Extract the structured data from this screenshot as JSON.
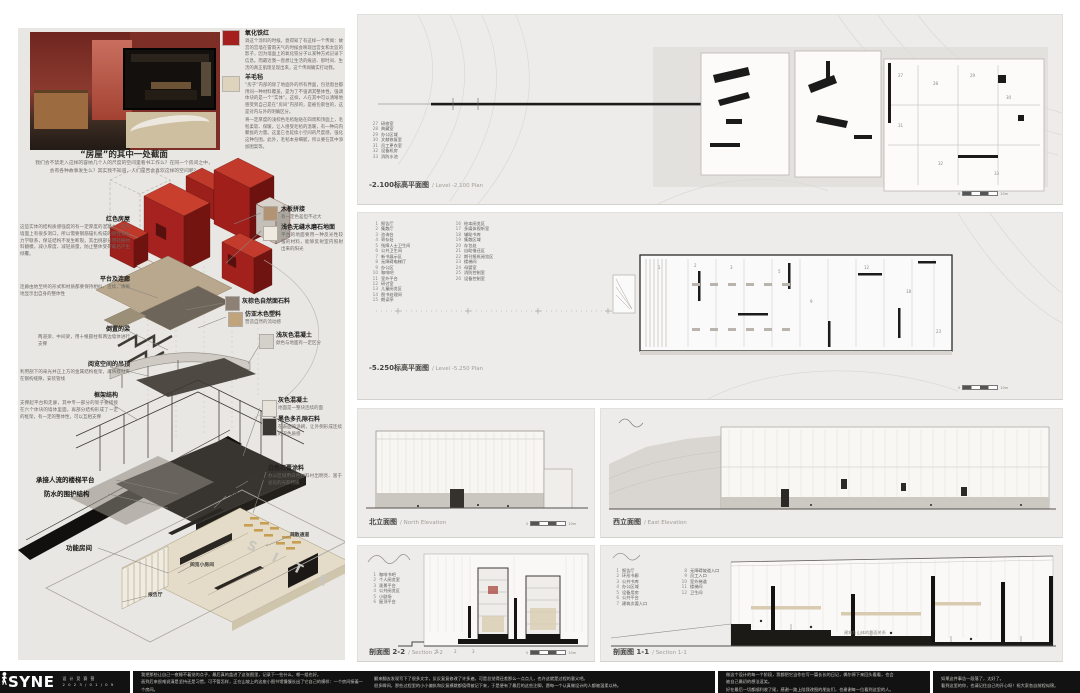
{
  "colors": {
    "accent_red": "#a5201c",
    "panel_bg": "#edecea",
    "footer_bg": "#121212"
  },
  "left": {
    "section_title": "“房屋”的其中一处截面",
    "section_body": "我们会不禁走入这样的容纳几个人的尺度的空间里看书工作么？在同一个房间之中，\n会有各种故事发生么？其实我不知道，人们是否会喜欢这样的空间呢？",
    "notes": [
      {
        "title": "氧化铁红",
        "swatch": "#a5201c",
        "body": "调这个涂料的时候，竟得知了有这样一个传闻：故宫的宫墙在雷雨天气的时候会映现出宫女和太监的影子，因为墙面上的氧化铁分子以某种方式记录下信息。而最近我一直想让生活的痕迹、那时间、生活的真正肌理呈现出来，这个传闻确实打动我。"
      },
      {
        "title": "羊毛毡",
        "swatch": "#ded3bd",
        "body": "“房子”内部的除了地面外的所有界面，包括窗台都用同一种材料覆盖，是为了不强调其整体性，强调体块的是一个“实体”。这样，人在其中可以清晰地感受到自己是在“房间”内部的，是被包裹住的，这是对内与外的明确区分。",
        "body2": "将一定厚度的浅棕色毛毡粘贴在四周和顶面上，毛毡柔软、保暖，让人感受毛毡的温暖，有一种向内聚拢的力量。这里它也延续小空间的尺度感，强化这种包围。此外，毛毡本身细腻，所以要在其中添加图案等。"
      }
    ],
    "axon_left": [
      {
        "title": "红色房屋",
        "body": "这些实体的结构质感强度的有一定厚度的混凝土，因为墙面上有很多洞口，所以需要钢筋锚扎构成的刚性发生力学联系，保证结构不发生断裂。其出挑部分用轻质材料翻模，减小厚度、减轻质量，防止整体受荷载后产生倾覆。"
      },
      {
        "title": "平台及连廊",
        "body": "连廊由始至终的形式和材质都要保持相似、连续，清晰地显示出自身的整体性"
      },
      {
        "title": "倒置的梁",
        "body": "两道梁、中间梁，用十根圆柱和两边墙体进行支撑"
      },
      {
        "title": "阅览空间的吊顶",
        "body": "利用剖下的采光井正上方的金属结构框架，再将膜材夹在钢构缝隙，安装管线"
      },
      {
        "title": "框架结构",
        "body": "支撑起平台和走廊，其中专一部分的架子要搭接在六个体块的墙体里面，再部分结构形成了一定的框架，有一定的整体性，可以互相支撑"
      },
      {
        "title": "承接人流的楼梯平台"
      },
      {
        "title": "防水的围护结构"
      },
      {
        "title": "功能房间"
      }
    ],
    "axon_right": [
      {
        "title": "木板拼接",
        "body": "有一定色差但不过大",
        "swatch": "#b29474"
      },
      {
        "title": "浅色无缝水磨石地面",
        "body": "平台的地面要用一种反光性较强的材料，能够反射室内照射出来的阳光",
        "swatch": "#efeadf"
      },
      {
        "title": "灰棕色自然面石料",
        "body": "",
        "swatch": "#8c8174"
      },
      {
        "title": "仿亚木色塑料",
        "body": "营造自然的流动感",
        "swatch": "#c2a47c"
      },
      {
        "title": "浅灰色混凝土",
        "body": "颜色与地面有一定区分",
        "swatch": "#d4d1ca"
      },
      {
        "title": "灰色混凝土",
        "body": "地面是一整块连续的面",
        "swatch": "#e7e3da"
      },
      {
        "title": "黑色多孔隙石料",
        "body": "在表面的涂刷，让外侧形成连续的深色质感",
        "swatch": "#3b3834"
      },
      {
        "title": "白色石膏涂料",
        "body": "办公区域用白色材料衬出明亮、富于变化的光影特质",
        "swatch": "#f4f1ea"
      }
    ],
    "inner_labels": {
      "corridor": "环廊+书库",
      "office": "办公区",
      "evac": "疏散通道",
      "lecture": "报告厅",
      "reading": "阅览小房间"
    }
  },
  "plans": {
    "p1": {
      "caption_zh": "-2.100标高平面图",
      "caption_en": "/ Level -2.100 Plan",
      "legend": [
        {
          "n": "27",
          "label": "研修室"
        },
        {
          "n": "28",
          "label": "典藏室"
        },
        {
          "n": "29",
          "label": "办公区域"
        },
        {
          "n": "30",
          "label": "文献修复室"
        },
        {
          "n": "31",
          "label": "员工更衣室"
        },
        {
          "n": "32",
          "label": "设备机房"
        },
        {
          "n": "33",
          "label": "消防水池"
        }
      ]
    },
    "p2": {
      "caption_zh": "-5.250标高平面图",
      "caption_en": "/ Level -5.250 Plan",
      "legend": [
        {
          "n": "1",
          "label": "报告厅"
        },
        {
          "n": "2",
          "label": "集散厅"
        },
        {
          "n": "3",
          "label": "咨询台"
        },
        {
          "n": "4",
          "label": "寄存处"
        },
        {
          "n": "5",
          "label": "残障人士卫生间"
        },
        {
          "n": "6",
          "label": "公共卫生间"
        },
        {
          "n": "7",
          "label": "新书展示区"
        },
        {
          "n": "8",
          "label": "无障碍电梯厅"
        },
        {
          "n": "9",
          "label": "办公区"
        },
        {
          "n": "10",
          "label": "咖啡吧"
        },
        {
          "n": "11",
          "label": "室外平台"
        },
        {
          "n": "12",
          "label": "研讨室"
        },
        {
          "n": "13",
          "label": "儿童阅览区"
        },
        {
          "n": "14",
          "label": "图书处理间"
        },
        {
          "n": "15",
          "label": "朗读亭"
        },
        {
          "n": "16",
          "label": "绘本阅览区"
        },
        {
          "n": "17",
          "label": "多媒体视听室"
        },
        {
          "n": "18",
          "label": "辅助书库"
        },
        {
          "n": "19",
          "label": "集散区域"
        },
        {
          "n": "20",
          "label": "存包处"
        },
        {
          "n": "21",
          "label": "自助借还区"
        },
        {
          "n": "22",
          "label": "期刊报纸阅览区"
        },
        {
          "n": "23",
          "label": "楼梯间"
        },
        {
          "n": "24",
          "label": "母婴室"
        },
        {
          "n": "25",
          "label": "消防控制室"
        },
        {
          "n": "26",
          "label": "设备控制室"
        }
      ]
    }
  },
  "elevations": {
    "north": {
      "zh": "北立面图",
      "en": "/ North Elevation"
    },
    "east": {
      "zh": "西立面图",
      "en": "/ East Elevation"
    }
  },
  "sections": {
    "s22": {
      "zh": "剖面图 2-2",
      "en": "/ Section 2-2",
      "legend": [
        {
          "n": "1",
          "label": "咖啡书吧"
        },
        {
          "n": "2",
          "label": "个人阅览室"
        },
        {
          "n": "3",
          "label": "观景平台"
        },
        {
          "n": "4",
          "label": "公共阅览区"
        },
        {
          "n": "5",
          "label": "小剧场"
        },
        {
          "n": "6",
          "label": "屋顶平台"
        }
      ]
    },
    "s11": {
      "zh": "剖面图 1-1",
      "en": "/ Section 1-1",
      "note": "建筑与山体的剖面关系",
      "legend": [
        {
          "n": "1",
          "label": "报告厅"
        },
        {
          "n": "2",
          "label": "环形书廊"
        },
        {
          "n": "3",
          "label": "公共书库"
        },
        {
          "n": "4",
          "label": "办公区域"
        },
        {
          "n": "5",
          "label": "设备用房"
        },
        {
          "n": "6",
          "label": "公共平台"
        },
        {
          "n": "7",
          "label": "建筑次要入口"
        },
        {
          "n": "8",
          "label": "无障碍坡道入口"
        },
        {
          "n": "9",
          "label": "员工入口"
        },
        {
          "n": "10",
          "label": "室外梯道"
        },
        {
          "n": "11",
          "label": "楼梯间"
        },
        {
          "n": "12",
          "label": "卫生间"
        }
      ]
    }
  },
  "scale": {
    "zero": "0",
    "end": "10m"
  },
  "footer": {
    "logo": "SYNE",
    "sub": "设 计 竞 赛 营",
    "date": "2 0 2 3 / 0 1 / 0 9",
    "blocks": [
      {
        "l1": "我把那些让自己一夜睡不着觉的点子，最后真的盖进了这张图里，记录下一些什么，哪一组也好。",
        "l2": "画到后来很难说清是坚持还是习惯，可不管怎样，正在山坡上的这座小图书馆慢慢长出了它自己的模样：一个房间接着一个房间。"
      },
      {
        "l1": "翻来翻去发现写下了很多文字，反反复复修改了许多遍，可是总觉得还差那么一点点儿，也许这就是过程的意义吧。",
        "l2": "很多瞬间，那些过程里的小小偏执和反复横跳都值得被记下来，于是便有了最后的这些注脚，愿每一个认真做设计的人都被温柔以待。"
      },
      {
        "l1": "做这个设计的每一个阶段，我都把它当作在写一篇长长的日记，偶尔停下来回头看看，也会被自己最初的想法逗笑。",
        "l2": "好在最后一切都顺利收了尾，感谢一路上陪我改图的朋友们，也谢谢每一位看到这里的人。"
      },
      {
        "l1": "如果这件事告一段落了，太好了。",
        "l2": "看到这里的你，也请记住自己的开心呀！祝大家各自前程似锦。"
      }
    ]
  }
}
